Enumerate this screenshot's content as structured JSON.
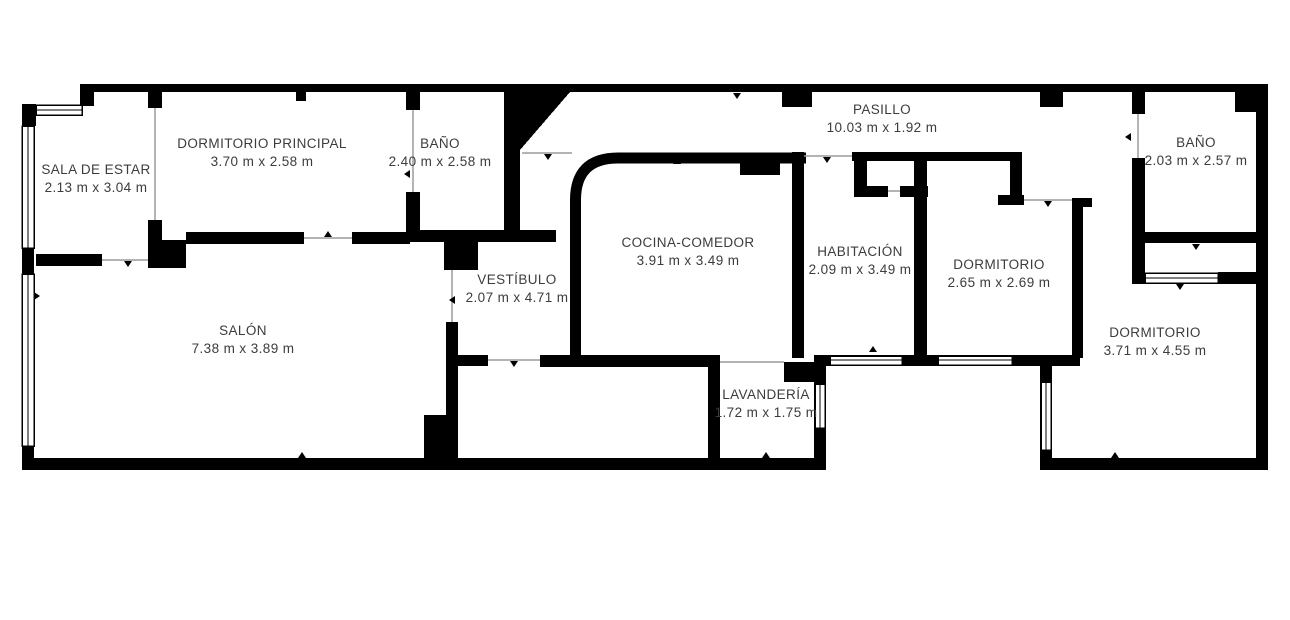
{
  "floorplan": {
    "type": "apartment-floor-plan",
    "colors": {
      "wall": "#000000",
      "background": "#ffffff",
      "text": "#3c3c3c",
      "door_line": "#9a9a9a"
    },
    "rooms": [
      {
        "id": "sala-de-estar",
        "name": "SALA DE ESTAR",
        "dims": "2.13 m x 3.04 m"
      },
      {
        "id": "dormitorio-principal",
        "name": "DORMITORIO PRINCIPAL",
        "dims": "3.70 m x 2.58 m"
      },
      {
        "id": "bano-1",
        "name": "BAÑO",
        "dims": "2.40 m x 2.58 m"
      },
      {
        "id": "pasillo",
        "name": "PASILLO",
        "dims": "10.03 m x 1.92 m"
      },
      {
        "id": "bano-2",
        "name": "BAÑO",
        "dims": "2.03 m x 2.57 m"
      },
      {
        "id": "cocina-comedor",
        "name": "COCINA-COMEDOR",
        "dims": "3.91 m x 3.49 m"
      },
      {
        "id": "habitacion",
        "name": "HABITACIÓN",
        "dims": "2.09 m x 3.49 m"
      },
      {
        "id": "dormitorio-2",
        "name": "DORMITORIO",
        "dims": "2.65 m x 2.69 m"
      },
      {
        "id": "vestibulo",
        "name": "VESTÍBULO",
        "dims": "2.07 m x 4.71 m"
      },
      {
        "id": "salon",
        "name": "SALÓN",
        "dims": "7.38 m x 3.89 m"
      },
      {
        "id": "lavanderia",
        "name": "LAVANDERÍA",
        "dims": "1.72 m x 1.75 m"
      },
      {
        "id": "dormitorio-3",
        "name": "DORMITORIO",
        "dims": "3.71 m x 4.55 m"
      }
    ]
  }
}
